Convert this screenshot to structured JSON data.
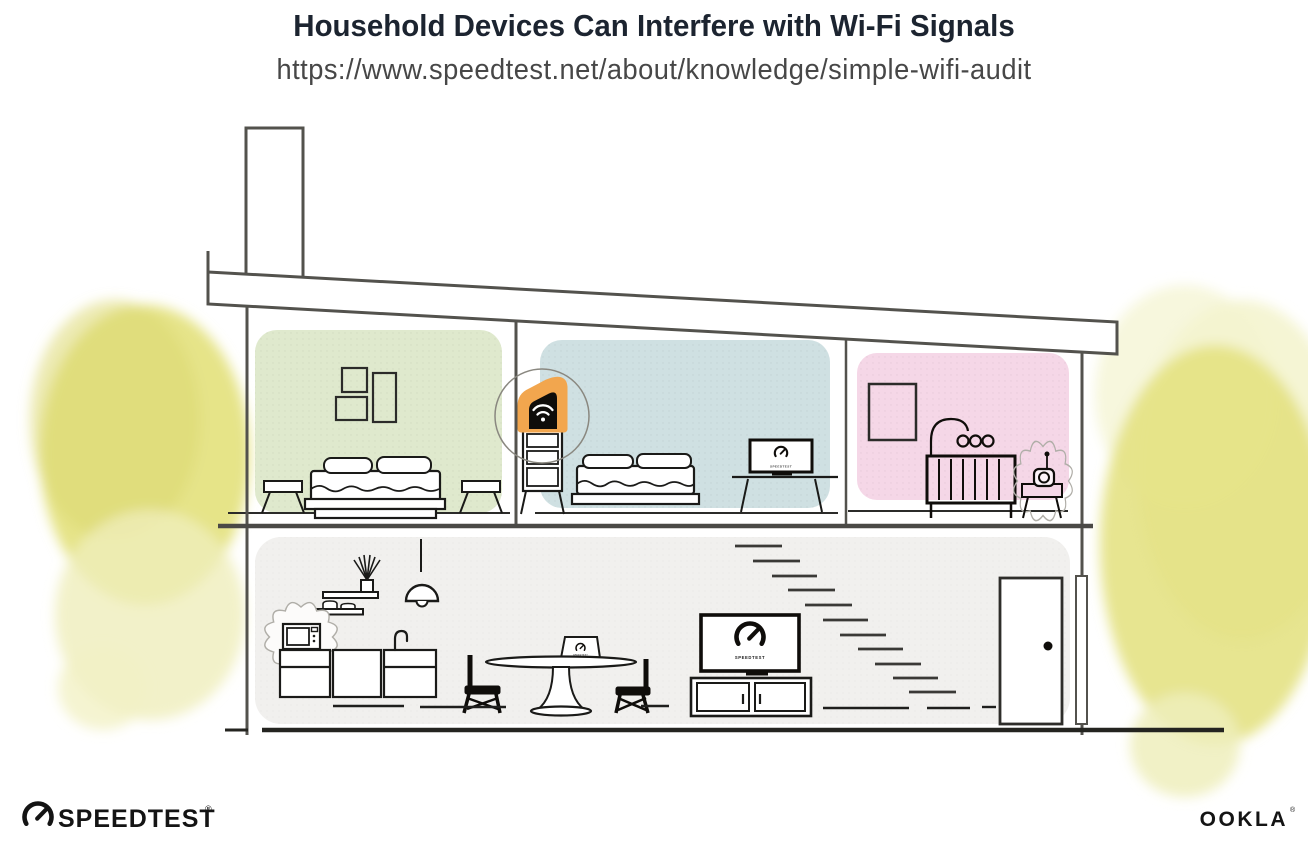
{
  "header": {
    "title": "Household Devices Can Interfere with Wi-Fi Signals",
    "url": "https://www.speedtest.net/about/knowledge/simple-wifi-audit"
  },
  "branding": {
    "speedtest_wordmark": "SPEEDTEST",
    "speedtest_trademark": "®",
    "ookla_wordmark": "OOKLA",
    "ookla_trademark": "®"
  },
  "screens": {
    "bedroom_monitor_label": "SPEEDTEST",
    "living_room_tv_label": "SPEEDTEST",
    "dining_laptop_label": "SPEEDTEST"
  },
  "icons": {
    "router": "wifi-icon",
    "speedtest": "gauge-icon"
  },
  "colors": {
    "accent_orange": "#F2A64E",
    "router_black": "#0F0D0A",
    "bedroom_green": "#DFE9CD",
    "bedroom_blue": "#CFE0E2",
    "nursery_pink": "#F5D7E7",
    "ground_floor_gray": "#F1F0EE",
    "foliage_yellow": "#E3E17C",
    "foliage_yellow_light": "#EFEEBC",
    "line_gray": "#53524D",
    "title_color": "#1C2430"
  }
}
